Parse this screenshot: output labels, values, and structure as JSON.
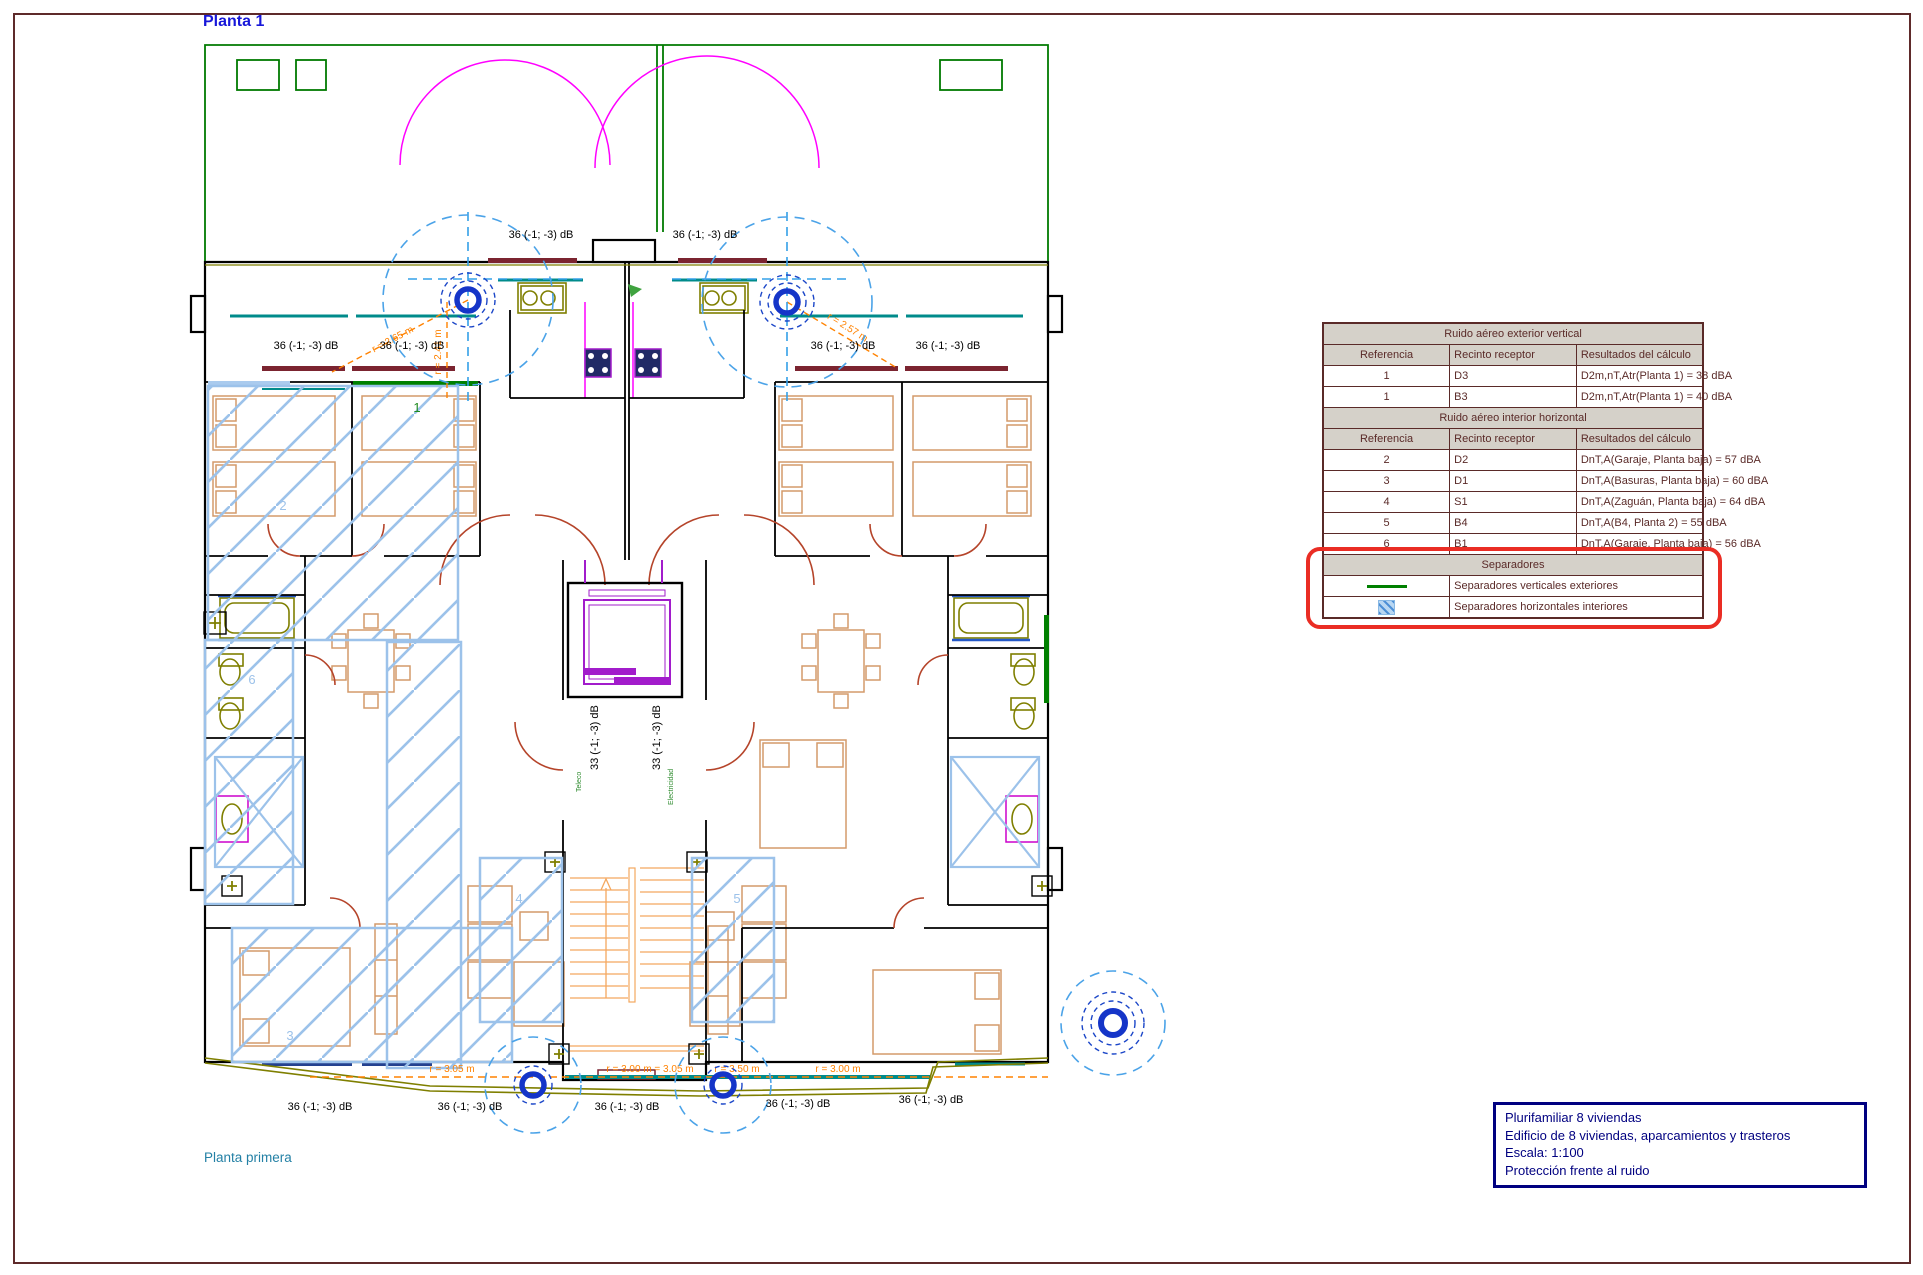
{
  "page": {
    "title": "Planta 1",
    "caption": "Planta primera"
  },
  "acoustic_table": {
    "s1_title": "Ruido aéreo exterior vertical",
    "headers": [
      "Referencia",
      "Recinto receptor",
      "Resultados del cálculo"
    ],
    "s1_rows": [
      [
        "1",
        "D3",
        "D2m,nT,Atr(Planta 1) = 38 dBA"
      ],
      [
        "1",
        "B3",
        "D2m,nT,Atr(Planta 1) = 40 dBA"
      ]
    ],
    "s2_title": "Ruido aéreo interior horizontal",
    "s2_rows": [
      [
        "2",
        "D2",
        "DnT,A(Garaje, Planta baja) = 57 dBA"
      ],
      [
        "3",
        "D1",
        "DnT,A(Basuras, Planta baja) = 60 dBA"
      ],
      [
        "4",
        "S1",
        "DnT,A(Zaguán, Planta baja) = 64 dBA"
      ],
      [
        "5",
        "B4",
        "DnT,A(B4, Planta 2) = 55 dBA"
      ],
      [
        "6",
        "B1",
        "DnT,A(Garaje, Planta baja) = 56 dBA"
      ]
    ],
    "sep_title": "Separadores",
    "sep_rows": [
      "Separadores verticales exteriores",
      "Separadores horizontales interiores"
    ]
  },
  "title_block": {
    "line1": "Plurifamiliar 8 viviendas",
    "line2": "Edificio de 8 viviendas, aparcamientos y trasteros",
    "line3": "Escala: 1:100",
    "line4": "Protección frente al ruido"
  },
  "plan": {
    "db_labels": [
      "36 (-1; -3) dB",
      "36 (-1; -3) dB",
      "36 (-1; -3) dB",
      "36 (-1; -3) dB",
      "36 (-1; -3) dB",
      "36 (-1; -3) dB",
      "36 (-1; -3) dB",
      "36 (-1; -3) dB",
      "36 (-1; -3) dB",
      "36 (-1; -3) dB",
      "36 (-1; -3) dB"
    ],
    "db_vertical_labels": [
      "33 (-1; -3) dB",
      "33 (-1; -3) dB"
    ],
    "dimension_labels": {
      "d1": "r = 2.65 m",
      "d2": "r = 2.41 m",
      "d3": "r = 2.57 m",
      "d4": "r = 3.05 m",
      "d5": "r = 3.00 m = 3.05 m",
      "d6": "r = 3.50 m",
      "d7": "r = 3.00 m"
    },
    "room_refs": {
      "r1": "1",
      "r2": "2",
      "r3": "3",
      "r4": "4",
      "r5": "5",
      "r6": "6"
    },
    "shaft_labels": {
      "s1": "Teleco",
      "s2": "Electricidad"
    }
  },
  "colors": {
    "sheet_border": "#5E2A2A",
    "title_blue": "#1717D9",
    "caption_teal": "#2380A5",
    "table_maroon": "#5A2A28",
    "highlight_red": "#EA2D24",
    "title_block_navy": "#000080",
    "separator_green": "#008000",
    "hatch_blue": "#9CC2EA",
    "noise_blue": "#1535C8",
    "dimension_orange": "#FF8200"
  }
}
